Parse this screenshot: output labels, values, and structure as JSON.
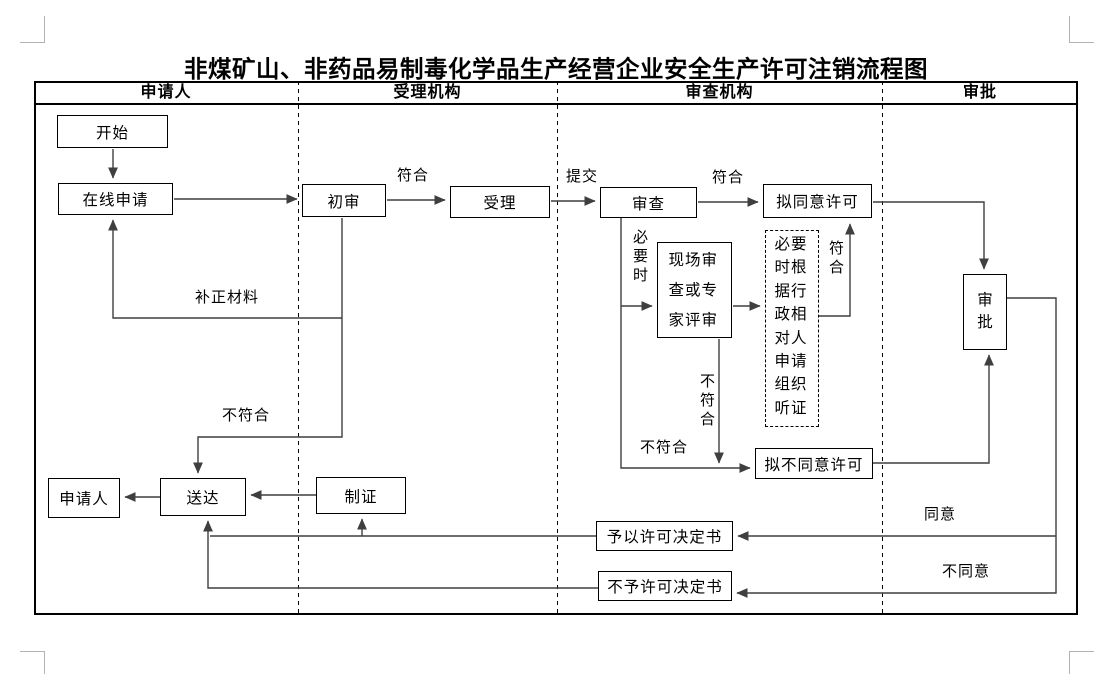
{
  "title": "非煤矿山、非药品易制毒化学品生产经营企业安全生产许可注销流程图",
  "lanes": {
    "applicant": "申请人",
    "acceptor": "受理机构",
    "reviewer": "审查机构",
    "approver": "审批"
  },
  "nodes": {
    "start": "开始",
    "online_apply": "在线申请",
    "initial_review": "初审",
    "accept": "受理",
    "review": "审查",
    "propose_approve": "拟同意许可",
    "onsite_review": "现场审查或专家评审",
    "hearing": "必要时根据行政相对人申请组织听证",
    "propose_disapprove": "拟不同意许可",
    "approval": "审批",
    "applicant": "申请人",
    "deliver": "送达",
    "make_cert": "制证",
    "grant_decision": "予以许可决定书",
    "deny_decision": "不予许可决定书"
  },
  "labels": {
    "conform_initial": "符合",
    "submit": "提交",
    "conform_review": "符合",
    "when_necessary": "必要时",
    "conform_hearing": "符合",
    "not_conform_onsite": "不符合",
    "not_conform_review": "不符合",
    "supplement": "补正材料",
    "not_conform_initial": "不符合",
    "agree": "同意",
    "disagree": "不同意"
  },
  "colors": {
    "line": "#3f3f3f",
    "border": "#000000",
    "crop_mark": "#b3b3b3"
  }
}
